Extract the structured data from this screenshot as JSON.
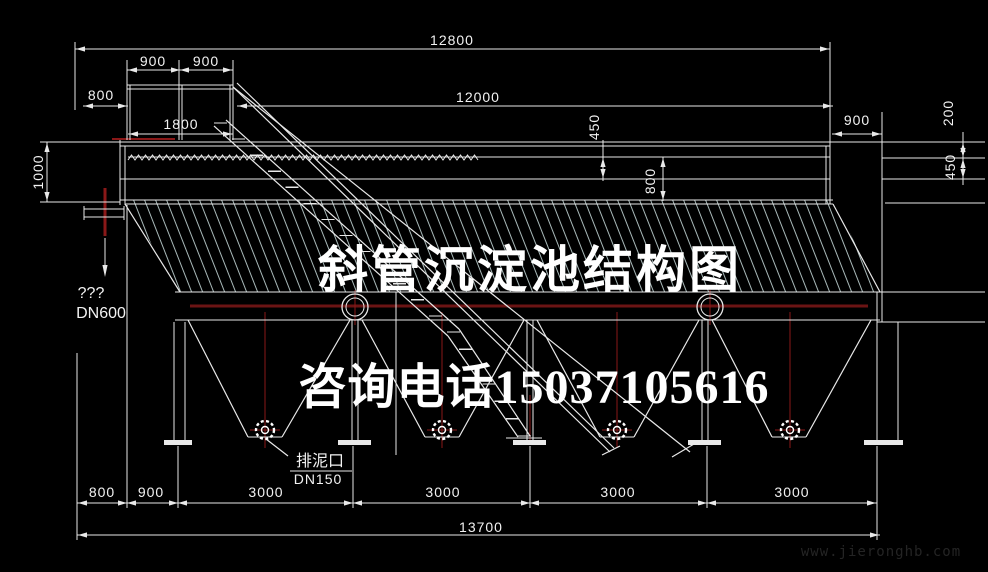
{
  "title": "斜管沉淀池结构图",
  "watermarks": {
    "phone": "咨询电话15037105616",
    "site": "www.jieronghb.com"
  },
  "annotations": {
    "outlet_q": "???",
    "outlet_dn": "DN600",
    "drain_label": "排泥口",
    "drain_dn": "DN150"
  },
  "dims": {
    "top_total": "12800",
    "inner_length": "12000",
    "platform_left": "900",
    "platform_right": "900",
    "left_gap": "800",
    "platform_width": "1800",
    "left_depth": "1000",
    "water_450": "450",
    "water_800": "800",
    "right_gap": "900",
    "right_200": "200",
    "right_450": "450",
    "bottom": [
      "800",
      "900",
      "3000",
      "3000",
      "3000",
      "3000"
    ],
    "bottom_total": "13700"
  },
  "colors": {
    "background": "#000000",
    "line": "#e9e9e9",
    "hatch": "#a9b9b9",
    "centerline": "#8a1818",
    "band_red": "#6b1414",
    "text": "#f2f2f2",
    "site_watermark": "#242424"
  }
}
